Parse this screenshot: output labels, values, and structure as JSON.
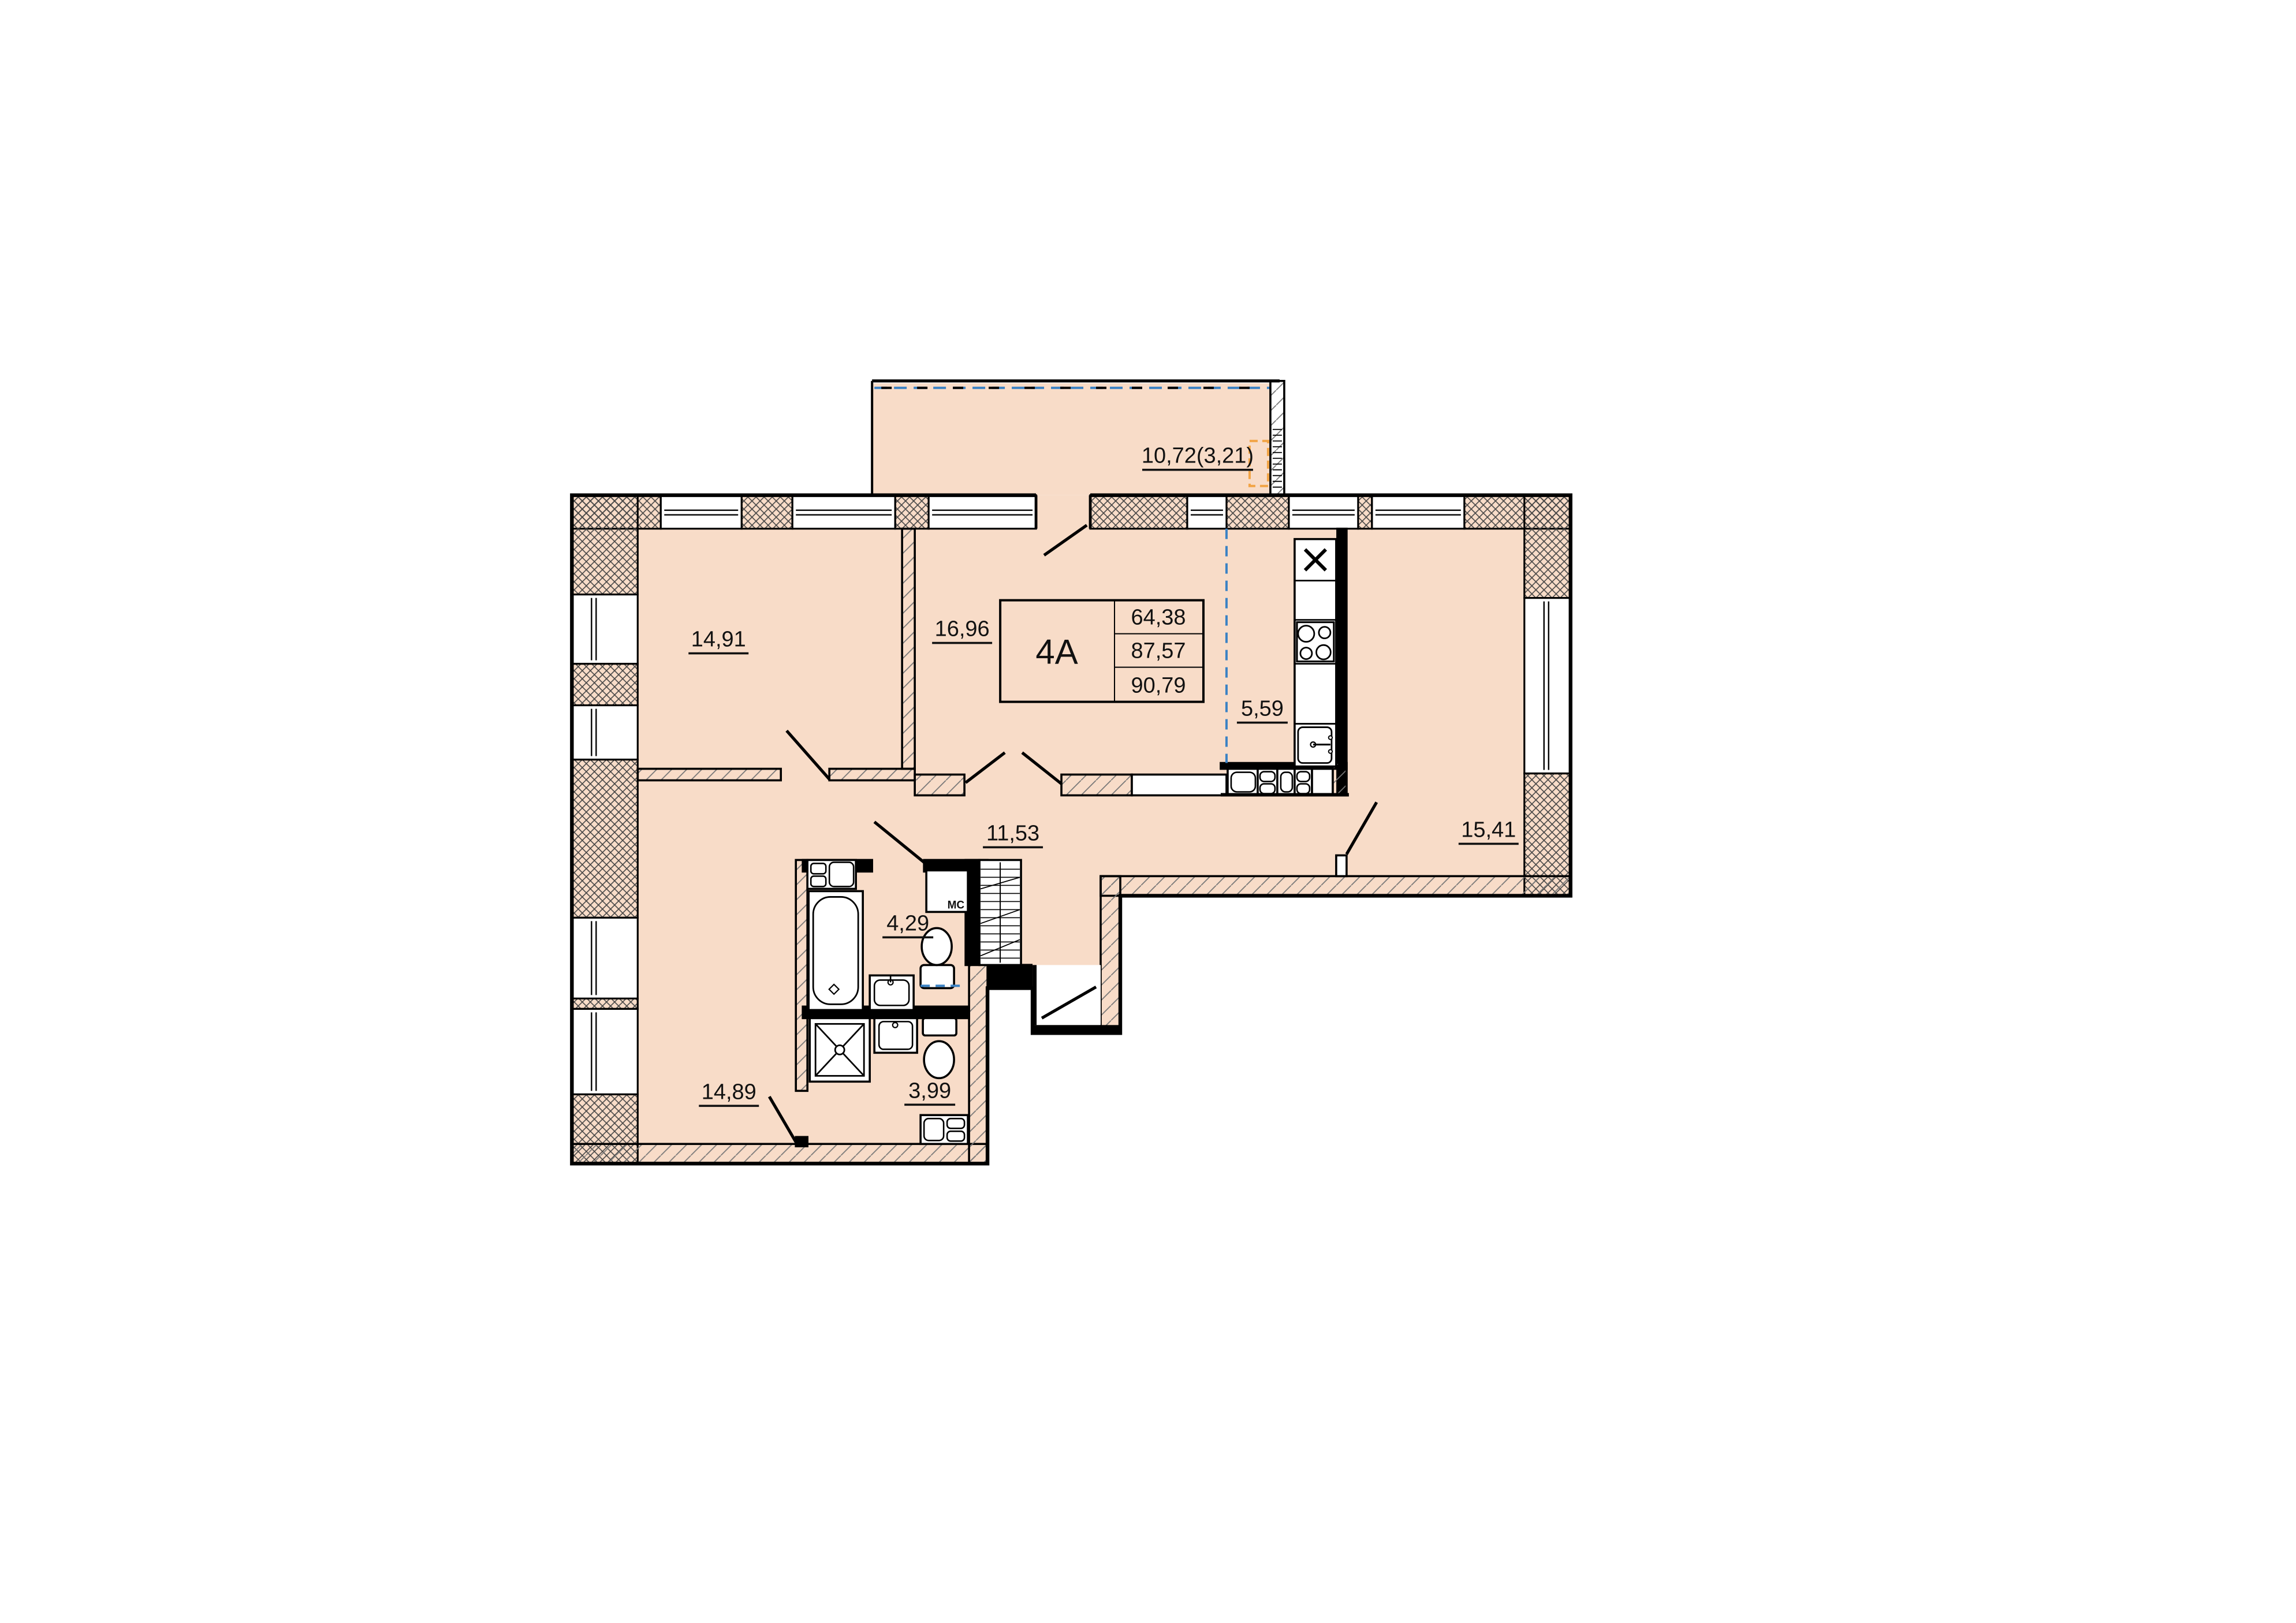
{
  "plan": {
    "unit": {
      "id": "4A",
      "living_area": "64,38",
      "apartment_area": "87,57",
      "total_area": "90,79"
    },
    "rooms": [
      {
        "name": "bedroom-top-left",
        "area": "14,91"
      },
      {
        "name": "living-room",
        "area": "16,96"
      },
      {
        "name": "kitchen-zone",
        "area": "5,59"
      },
      {
        "name": "bedroom-right",
        "area": "15,41"
      },
      {
        "name": "hallway",
        "area": "11,53"
      },
      {
        "name": "bathroom",
        "area": "4,29"
      },
      {
        "name": "bedroom-bottom-left",
        "area": "14,89"
      },
      {
        "name": "wc",
        "area": "3,99"
      },
      {
        "name": "balcony",
        "area": "10,72(3,21)"
      }
    ],
    "markers": {
      "washer_spot": "МС"
    },
    "colors": {
      "floor": "#f8dcc8",
      "wall": "#000000",
      "zone_divider_dash": "#3b82c4",
      "balcony_marker_dash": "#f2a445"
    }
  }
}
